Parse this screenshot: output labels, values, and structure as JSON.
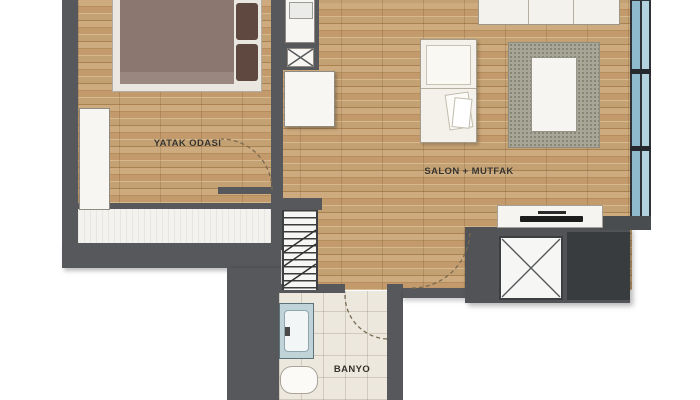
{
  "plan_title": "apartment-floor-plan",
  "rooms": {
    "bedroom": "YATAK ODASI",
    "living_kitchen": "SALON + MUTFAK",
    "bathroom": "BANYO"
  },
  "fixtures": [
    "bed",
    "wardrobe",
    "kitchen-cabinet-sink",
    "kitchen-cabinet-crossed",
    "kitchen-cabinet-large",
    "armchair",
    "sofa",
    "rug",
    "coffee-table",
    "tv-console",
    "window-band",
    "stairs",
    "elevator-shaft",
    "service-block",
    "bath-vanity",
    "toilet",
    "balcony-strip"
  ],
  "colors": {
    "wall": "#56585b",
    "dark_block": "#393c3e",
    "wood_base": "#c4a172",
    "window_glass": "#8fb9cc",
    "rug": "#a7a698",
    "bed_blanket": "#8b7770",
    "bathroom_tile": "#ece8dd",
    "paper_white": "#f7f6f3"
  }
}
